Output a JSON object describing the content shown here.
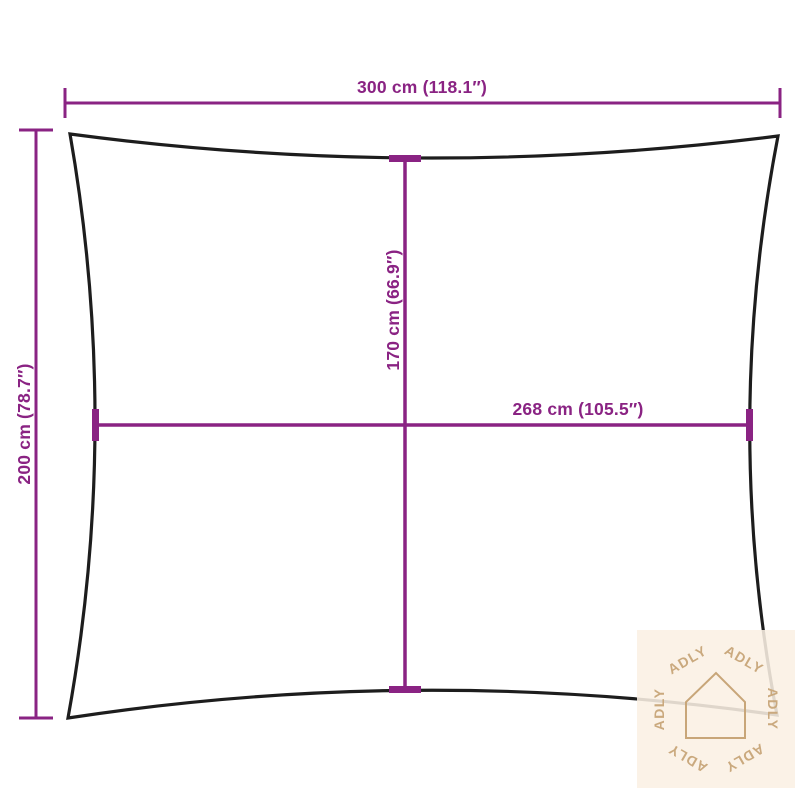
{
  "diagram": {
    "title": "shade-sail-dimension-diagram",
    "dimensions": {
      "top_width": "300 cm (118.1″)",
      "left_height": "200 cm (78.7″)",
      "center_height": "170 cm (66.9″)",
      "center_width": "268 cm (105.5″)"
    }
  },
  "watermark": {
    "text": "ADLY",
    "icon": "house-icon"
  },
  "colors": {
    "dimension_line": "#8a2383",
    "sail_outline": "#1d1d1d",
    "watermark_foreground": "#c8a679",
    "watermark_background": "#fbf0e4",
    "background": "#ffffff"
  }
}
